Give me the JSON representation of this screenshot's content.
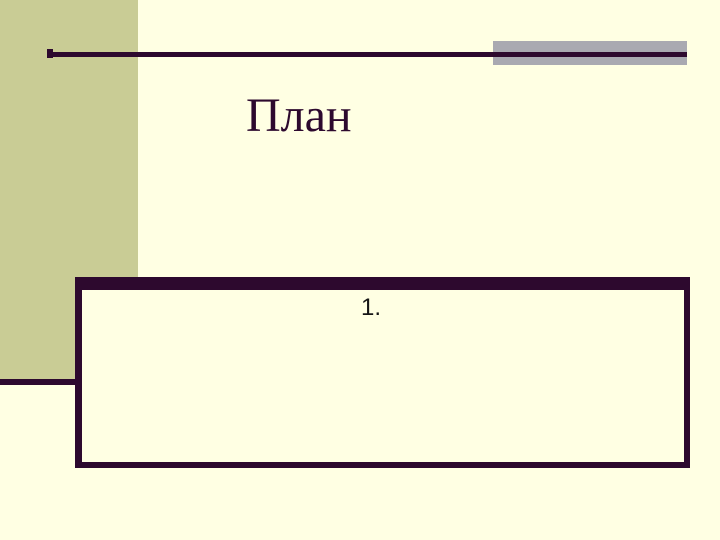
{
  "slide": {
    "title": "План",
    "body": {
      "item_number": "1."
    }
  },
  "colors": {
    "background": "#FFFFE3",
    "left_band": "#C9CC95",
    "accent_dark_purple": "#2D092E",
    "accent_gray": "#A9A9B1",
    "title_text": "#2D092E",
    "body_text": "#151515"
  }
}
